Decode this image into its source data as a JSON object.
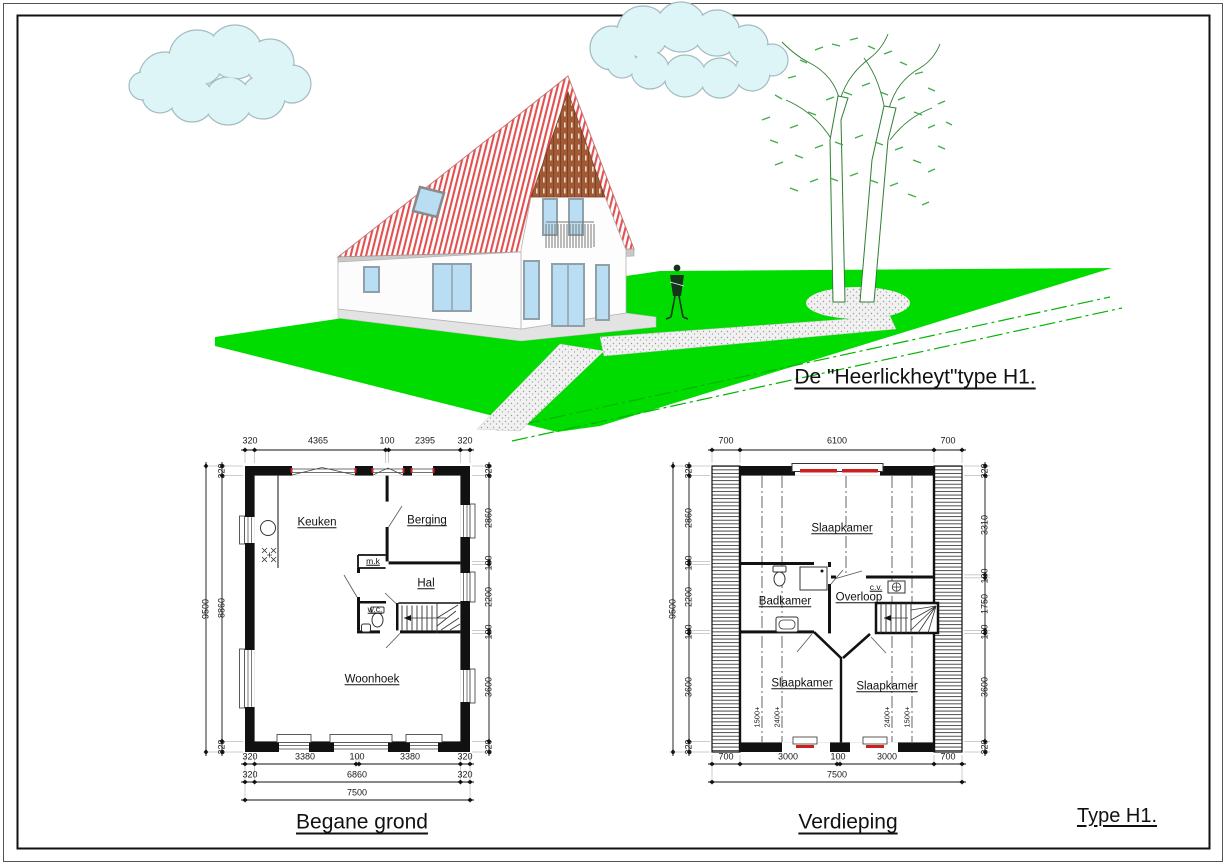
{
  "title": "De \"Heerlickheyt\"type H1.",
  "footer_type_label": "Type H1.",
  "colors": {
    "roof_red": "#e35050",
    "wood_brown": "#a25a36",
    "lawn_green": "#00dc00",
    "boundary_green": "#00b400",
    "cloud_fill": "#def5f8",
    "window_blue": "#b9ddf2",
    "plan_red_marks": "#cc2020"
  },
  "ground_floor": {
    "caption": "Begane grond",
    "rooms": {
      "kitchen": "Keuken",
      "storage": "Berging",
      "meter_cupboard": "m.k",
      "hall": "Hal",
      "toilet": "w.c.",
      "living_area": "Woonhoek"
    },
    "dims": {
      "top": [
        "320",
        "4365",
        "100",
        "2395",
        "320"
      ],
      "left_total": "9500",
      "left": [
        "320",
        "8860",
        "320"
      ],
      "right": [
        "320",
        "2860",
        "100",
        "2200",
        "100",
        "3600",
        "320"
      ],
      "bottom_row1": [
        "320",
        "3380",
        "100",
        "3380",
        "320"
      ],
      "bottom_row2": [
        "320",
        "6860",
        "320"
      ],
      "bottom_total": "7500"
    }
  },
  "upper_floor": {
    "caption": "Verdieping",
    "rooms": {
      "bedroom_top": "Slaapkamer",
      "bathroom": "Badkamer",
      "landing": "Overloop",
      "heating": "c.v.",
      "bedroom_left": "Slaapkamer",
      "bedroom_right": "Slaapkamer"
    },
    "roof_height_labels": [
      "1500+",
      "2400+",
      "2400+",
      "1500+"
    ],
    "dims": {
      "top": [
        "700",
        "6100",
        "700"
      ],
      "left_total": "9500",
      "left": [
        "320",
        "2860",
        "100",
        "2200",
        "100",
        "3600",
        "320"
      ],
      "right": [
        "320",
        "3310",
        "100",
        "1750",
        "100",
        "3600",
        "320"
      ],
      "bottom_row1": [
        "700",
        "3000",
        "100",
        "3000",
        "700"
      ],
      "bottom_total": "7500"
    }
  }
}
